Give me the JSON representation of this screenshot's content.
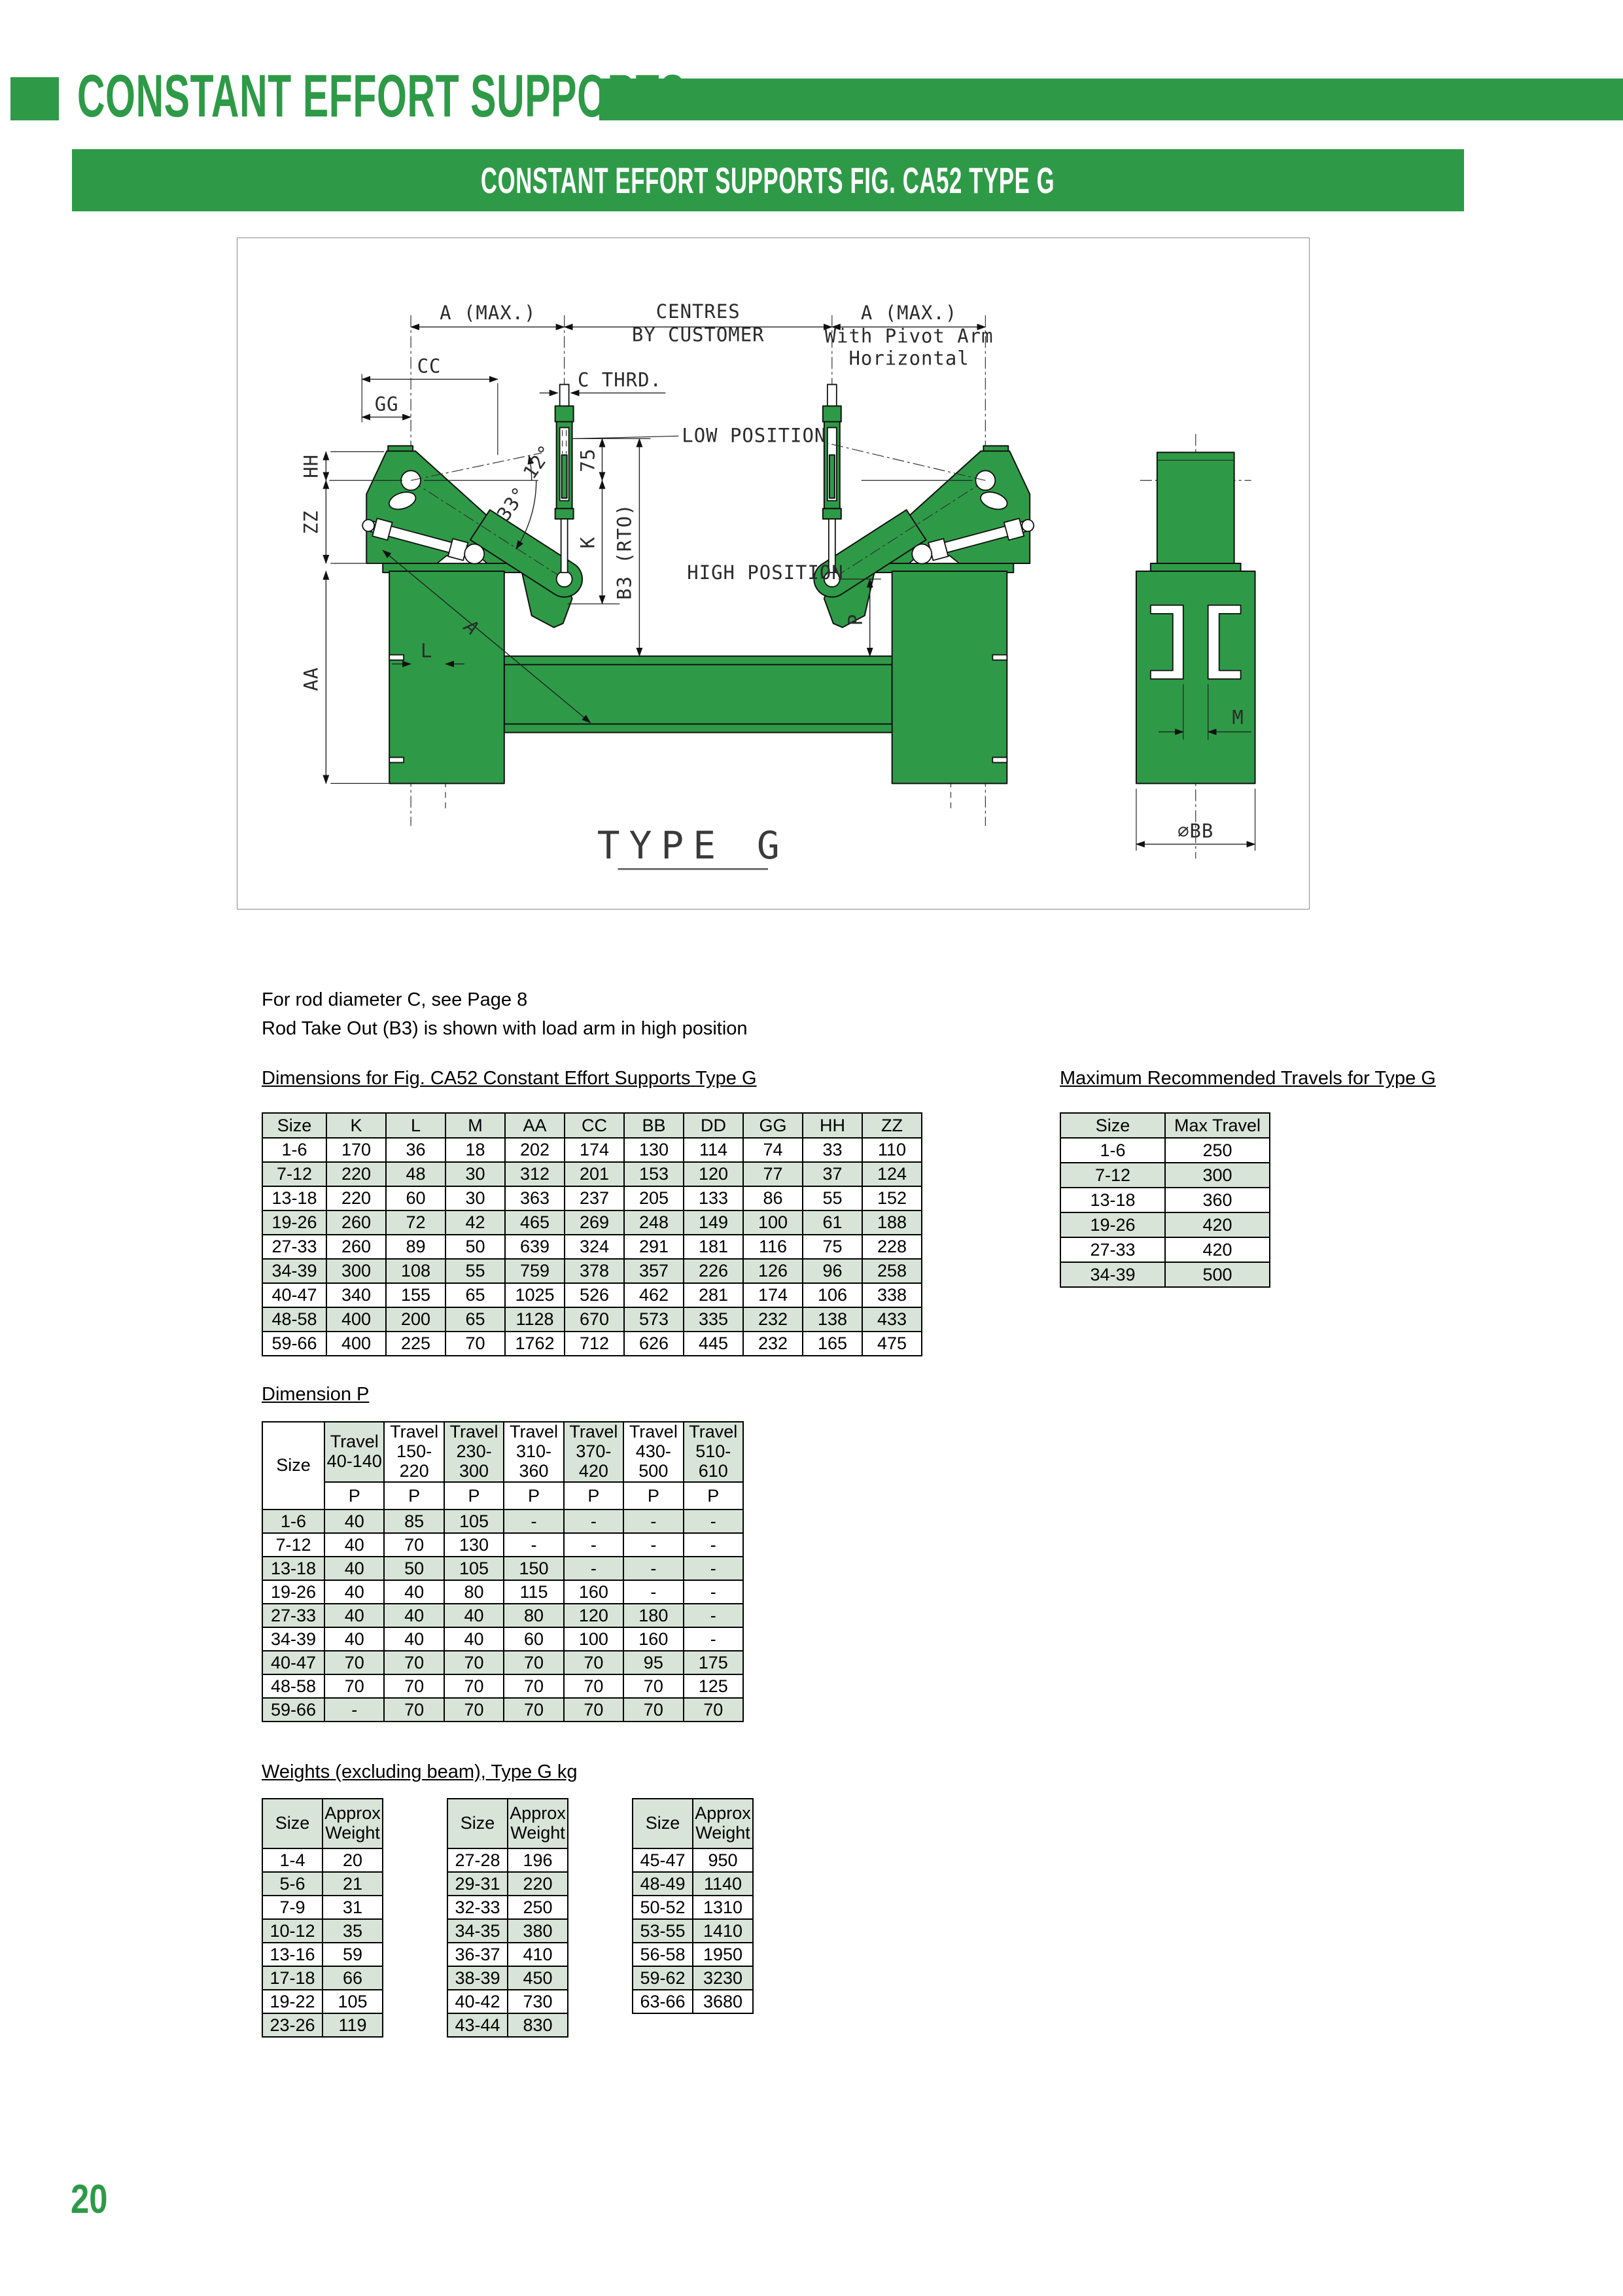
{
  "header": {
    "title": "CONSTANT EFFORT SUPPORTS",
    "banner": "CONSTANT EFFORT SUPPORTS FIG. CA52 TYPE G"
  },
  "colors": {
    "accent_green": "#2e9a47",
    "table_green": "#d8e4d8"
  },
  "page_number": "20",
  "notes": [
    "For rod diameter C, see Page 8",
    "Rod Take Out (B3) is shown with load arm in high position"
  ],
  "headings": {
    "dimensions": "Dimensions for Fig. CA52 Constant Effort Supports Type G",
    "travels": "Maximum Recommended Travels for Type G",
    "dimension_p": "Dimension P",
    "weights": "Weights (excluding beam), Type G kg"
  },
  "drawing": {
    "labels": {
      "a_max": "A (MAX.)",
      "centres": "CENTRES",
      "by_customer": "BY CUSTOMER",
      "with_pivot": "With Pivot Arm",
      "horizontal": "Horizontal",
      "cc": "CC",
      "gg": "GG",
      "hh": "HH",
      "zz": "ZZ",
      "aa": "AA",
      "l": "L",
      "a": "A",
      "c_thrd": "C THRD.",
      "low_position": "LOW POSITION",
      "high_position": "HIGH POSITION",
      "deg12": "12°",
      "deg33": "33°",
      "n75": "75",
      "k": "K",
      "b3": "B3 (RTO)",
      "p": "P",
      "m": "M",
      "bb": "∅BB",
      "type_g": "TYPE G"
    }
  },
  "tables": {
    "dimensions": {
      "columns": [
        "Size",
        "K",
        "L",
        "M",
        "AA",
        "CC",
        "BB",
        "DD",
        "GG",
        "HH",
        "ZZ"
      ],
      "rows": [
        [
          "1-6",
          "170",
          "36",
          "18",
          "202",
          "174",
          "130",
          "114",
          "74",
          "33",
          "110"
        ],
        [
          "7-12",
          "220",
          "48",
          "30",
          "312",
          "201",
          "153",
          "120",
          "77",
          "37",
          "124"
        ],
        [
          "13-18",
          "220",
          "60",
          "30",
          "363",
          "237",
          "205",
          "133",
          "86",
          "55",
          "152"
        ],
        [
          "19-26",
          "260",
          "72",
          "42",
          "465",
          "269",
          "248",
          "149",
          "100",
          "61",
          "188"
        ],
        [
          "27-33",
          "260",
          "89",
          "50",
          "639",
          "324",
          "291",
          "181",
          "116",
          "75",
          "228"
        ],
        [
          "34-39",
          "300",
          "108",
          "55",
          "759",
          "378",
          "357",
          "226",
          "126",
          "96",
          "258"
        ],
        [
          "40-47",
          "340",
          "155",
          "65",
          "1025",
          "526",
          "462",
          "281",
          "174",
          "106",
          "338"
        ],
        [
          "48-58",
          "400",
          "200",
          "65",
          "1128",
          "670",
          "573",
          "335",
          "232",
          "138",
          "433"
        ],
        [
          "59-66",
          "400",
          "225",
          "70",
          "1762",
          "712",
          "626",
          "445",
          "232",
          "165",
          "475"
        ]
      ],
      "stripe": "white-first"
    },
    "travels": {
      "columns": [
        "Size",
        "Max Travel"
      ],
      "rows": [
        [
          "1-6",
          "250"
        ],
        [
          "7-12",
          "300"
        ],
        [
          "13-18",
          "360"
        ],
        [
          "19-26",
          "420"
        ],
        [
          "27-33",
          "420"
        ],
        [
          "34-39",
          "500"
        ]
      ],
      "stripe": "white-first"
    },
    "dimension_p": {
      "size_label": "Size",
      "travel_columns": [
        "Travel 40-140",
        "Travel 150- 220",
        "Travel 230- 300",
        "Travel 310- 360",
        "Travel 370- 420",
        "Travel 430- 500",
        "Travel 510- 610"
      ],
      "header_colors": [
        "g",
        "w",
        "g",
        "w",
        "g",
        "w",
        "g"
      ],
      "subheader": "P",
      "rows": [
        [
          "1-6",
          "40",
          "85",
          "105",
          "-",
          "-",
          "-",
          "-"
        ],
        [
          "7-12",
          "40",
          "70",
          "130",
          "-",
          "-",
          "-",
          "-"
        ],
        [
          "13-18",
          "40",
          "50",
          "105",
          "150",
          "-",
          "-",
          "-"
        ],
        [
          "19-26",
          "40",
          "40",
          "80",
          "115",
          "160",
          "-",
          "-"
        ],
        [
          "27-33",
          "40",
          "40",
          "40",
          "80",
          "120",
          "180",
          "-"
        ],
        [
          "34-39",
          "40",
          "40",
          "40",
          "60",
          "100",
          "160",
          "-"
        ],
        [
          "40-47",
          "70",
          "70",
          "70",
          "70",
          "70",
          "95",
          "175"
        ],
        [
          "48-58",
          "70",
          "70",
          "70",
          "70",
          "70",
          "70",
          "125"
        ],
        [
          "59-66",
          "-",
          "70",
          "70",
          "70",
          "70",
          "70",
          "70"
        ]
      ],
      "stripe": "green-first"
    },
    "weights_1": {
      "columns": [
        "Size",
        "Approx Weight"
      ],
      "rows": [
        [
          "1-4",
          "20"
        ],
        [
          "5-6",
          "21"
        ],
        [
          "7-9",
          "31"
        ],
        [
          "10-12",
          "35"
        ],
        [
          "13-16",
          "59"
        ],
        [
          "17-18",
          "66"
        ],
        [
          "19-22",
          "105"
        ],
        [
          "23-26",
          "119"
        ]
      ],
      "stripe": "white-first"
    },
    "weights_2": {
      "columns": [
        "Size",
        "Approx Weight"
      ],
      "rows": [
        [
          "27-28",
          "196"
        ],
        [
          "29-31",
          "220"
        ],
        [
          "32-33",
          "250"
        ],
        [
          "34-35",
          "380"
        ],
        [
          "36-37",
          "410"
        ],
        [
          "38-39",
          "450"
        ],
        [
          "40-42",
          "730"
        ],
        [
          "43-44",
          "830"
        ]
      ],
      "stripe": "white-first"
    },
    "weights_3": {
      "columns": [
        "Size",
        "Approx Weight"
      ],
      "rows": [
        [
          "45-47",
          "950"
        ],
        [
          "48-49",
          "1140"
        ],
        [
          "50-52",
          "1310"
        ],
        [
          "53-55",
          "1410"
        ],
        [
          "56-58",
          "1950"
        ],
        [
          "59-62",
          "3230"
        ],
        [
          "63-66",
          "3680"
        ]
      ],
      "stripe": "white-first"
    }
  }
}
